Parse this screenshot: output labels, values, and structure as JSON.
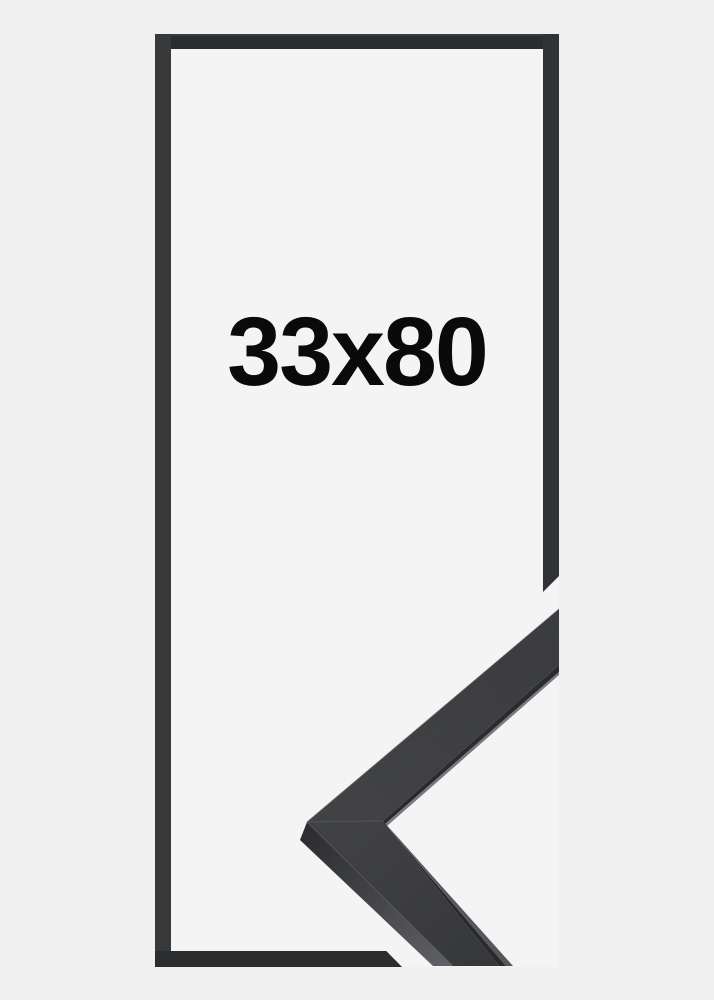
{
  "product": {
    "size_label": "33x80",
    "description": "frame-size-illustration"
  },
  "colors": {
    "page_bg": "#f0f0f1",
    "frame_interior": "#f4f4f5",
    "frame_border_top": "#2b2c2e",
    "frame_border_left": "#38393b",
    "frame_border_right": "#313235",
    "frame_border_bottom": "#2c2d2f",
    "moulding_face_top_arm": "#38393b",
    "moulding_face_bottom_arm": "#343538",
    "moulding_side_dark": "#26272a",
    "moulding_side_light": "#5c5d62",
    "lip_shadow": "#232427",
    "lip_highlight": "#77787d",
    "mitre_seam": "#4a4b4f",
    "label_text": "#0a0a0b"
  }
}
